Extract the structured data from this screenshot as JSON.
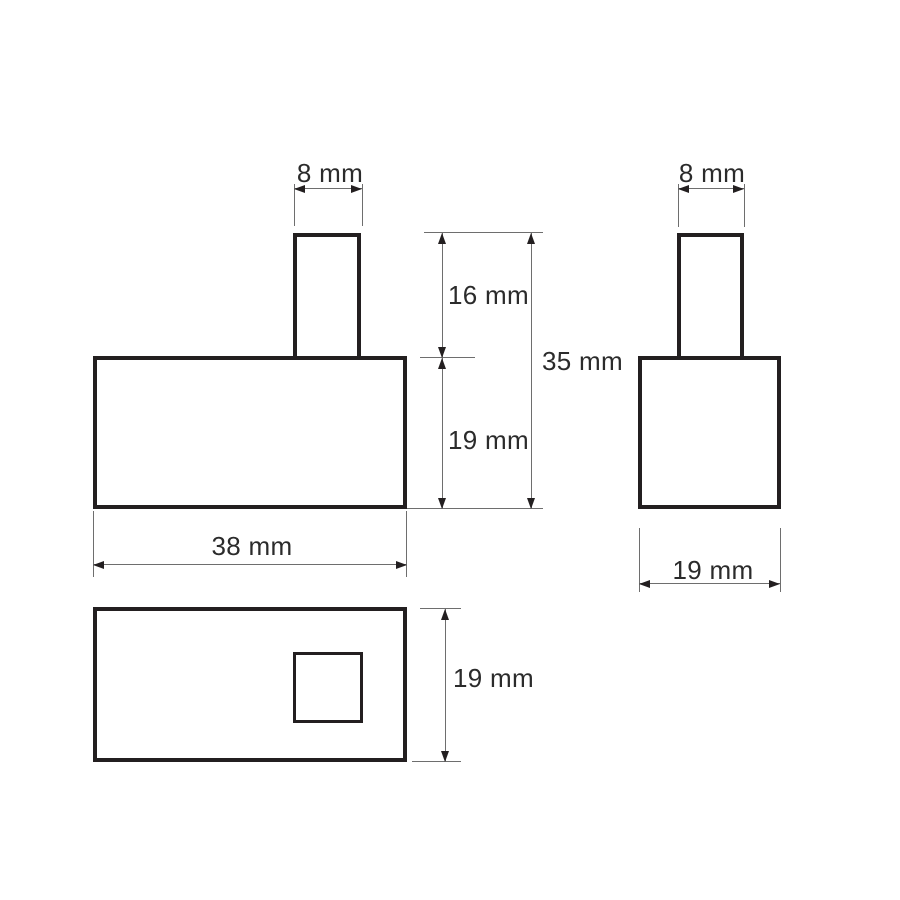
{
  "drawing": {
    "kind": "orthographic-dimension-drawing",
    "colors": {
      "background": "#ffffff",
      "outline": "#231f20",
      "dimension_line": "#6e6e6e",
      "text": "#2b2b2b"
    },
    "views": {
      "front": {
        "dims": {
          "stem_width": {
            "label": "8 mm"
          },
          "stem_height": {
            "label": "16 mm"
          },
          "body_height": {
            "label": "19 mm"
          },
          "total_height": {
            "label": "35 mm"
          },
          "body_width": {
            "label": "38 mm"
          }
        }
      },
      "side": {
        "dims": {
          "stem_width": {
            "label": "8 mm"
          },
          "body_width": {
            "label": "19 mm"
          }
        }
      },
      "top": {
        "dims": {
          "depth": {
            "label": "19 mm"
          }
        }
      }
    }
  }
}
